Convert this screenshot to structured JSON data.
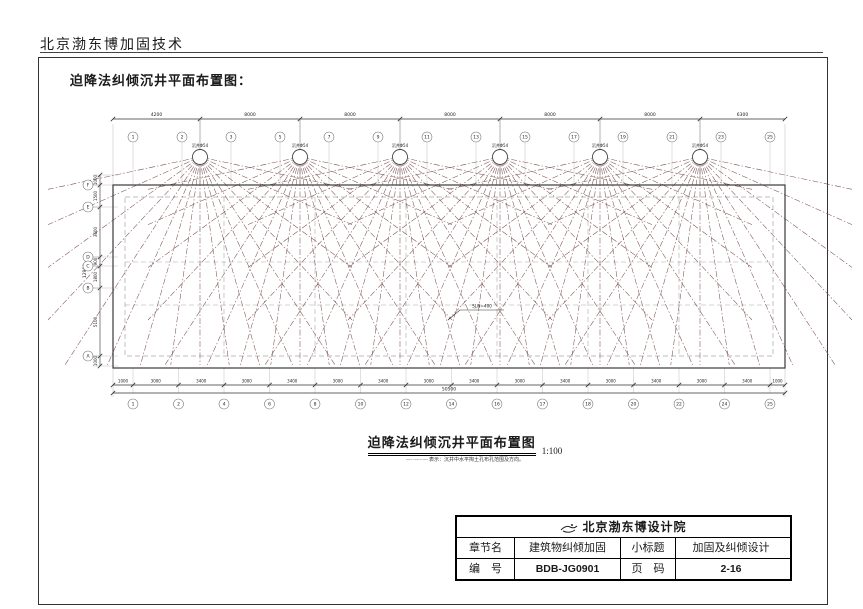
{
  "header": {
    "company": "北京渤东博加固技术"
  },
  "caption": "迫降法纠倾沉井平面布置图：",
  "plan": {
    "title": "迫降法纠倾沉井平面布置图",
    "scale": "1:100",
    "legend": "—··—··—  表示：沉井中水平掏土孔布孔范围及方向。",
    "well_label": "沉井Φ54",
    "well_count": 6,
    "annotation": "SJ,N=400",
    "axes": {
      "top_bubbles": [
        "1",
        "2",
        "3",
        "5",
        "7",
        "9",
        "11",
        "13",
        "15",
        "17",
        "19",
        "21",
        "23",
        "25"
      ],
      "bottom_bubbles": [
        "1",
        "2",
        "4",
        "6",
        "8",
        "10",
        "12",
        "14",
        "16",
        "17",
        "18",
        "20",
        "22",
        "24",
        "25"
      ],
      "left_bubbles": [
        "F",
        "E",
        "D",
        "C",
        "B",
        "A"
      ],
      "top_dims": [
        "4200",
        "8000",
        "8000",
        "8000",
        "8000",
        "8000",
        "6300"
      ],
      "bottom_dims": [
        "1000",
        "3000",
        "3400",
        "3000",
        "3400",
        "3000",
        "3400",
        "3000",
        "3400",
        "3000",
        "3400",
        "3000",
        "3400",
        "3000",
        "3400",
        "1000"
      ],
      "bottom_total": "50500",
      "left_dims": [
        "1000",
        "1500",
        "3600",
        "900",
        "1800",
        "5100",
        "1000"
      ],
      "left_total": "12900"
    },
    "colors": {
      "ray": "#7d5050",
      "line": "#3a3a3a",
      "light": "#b9b9b9",
      "dash": "#a8a8a8"
    }
  },
  "title_block": {
    "office": "北京渤东博设计院",
    "row1": {
      "label_a": "章节名",
      "value_a": "建筑物纠倾加固",
      "label_b": "小标题",
      "value_b": "加固及纠倾设计"
    },
    "row2": {
      "label_a": "编　号",
      "value_a": "BDB-JG0901",
      "label_b": "页　码",
      "value_b": "2-16"
    }
  }
}
